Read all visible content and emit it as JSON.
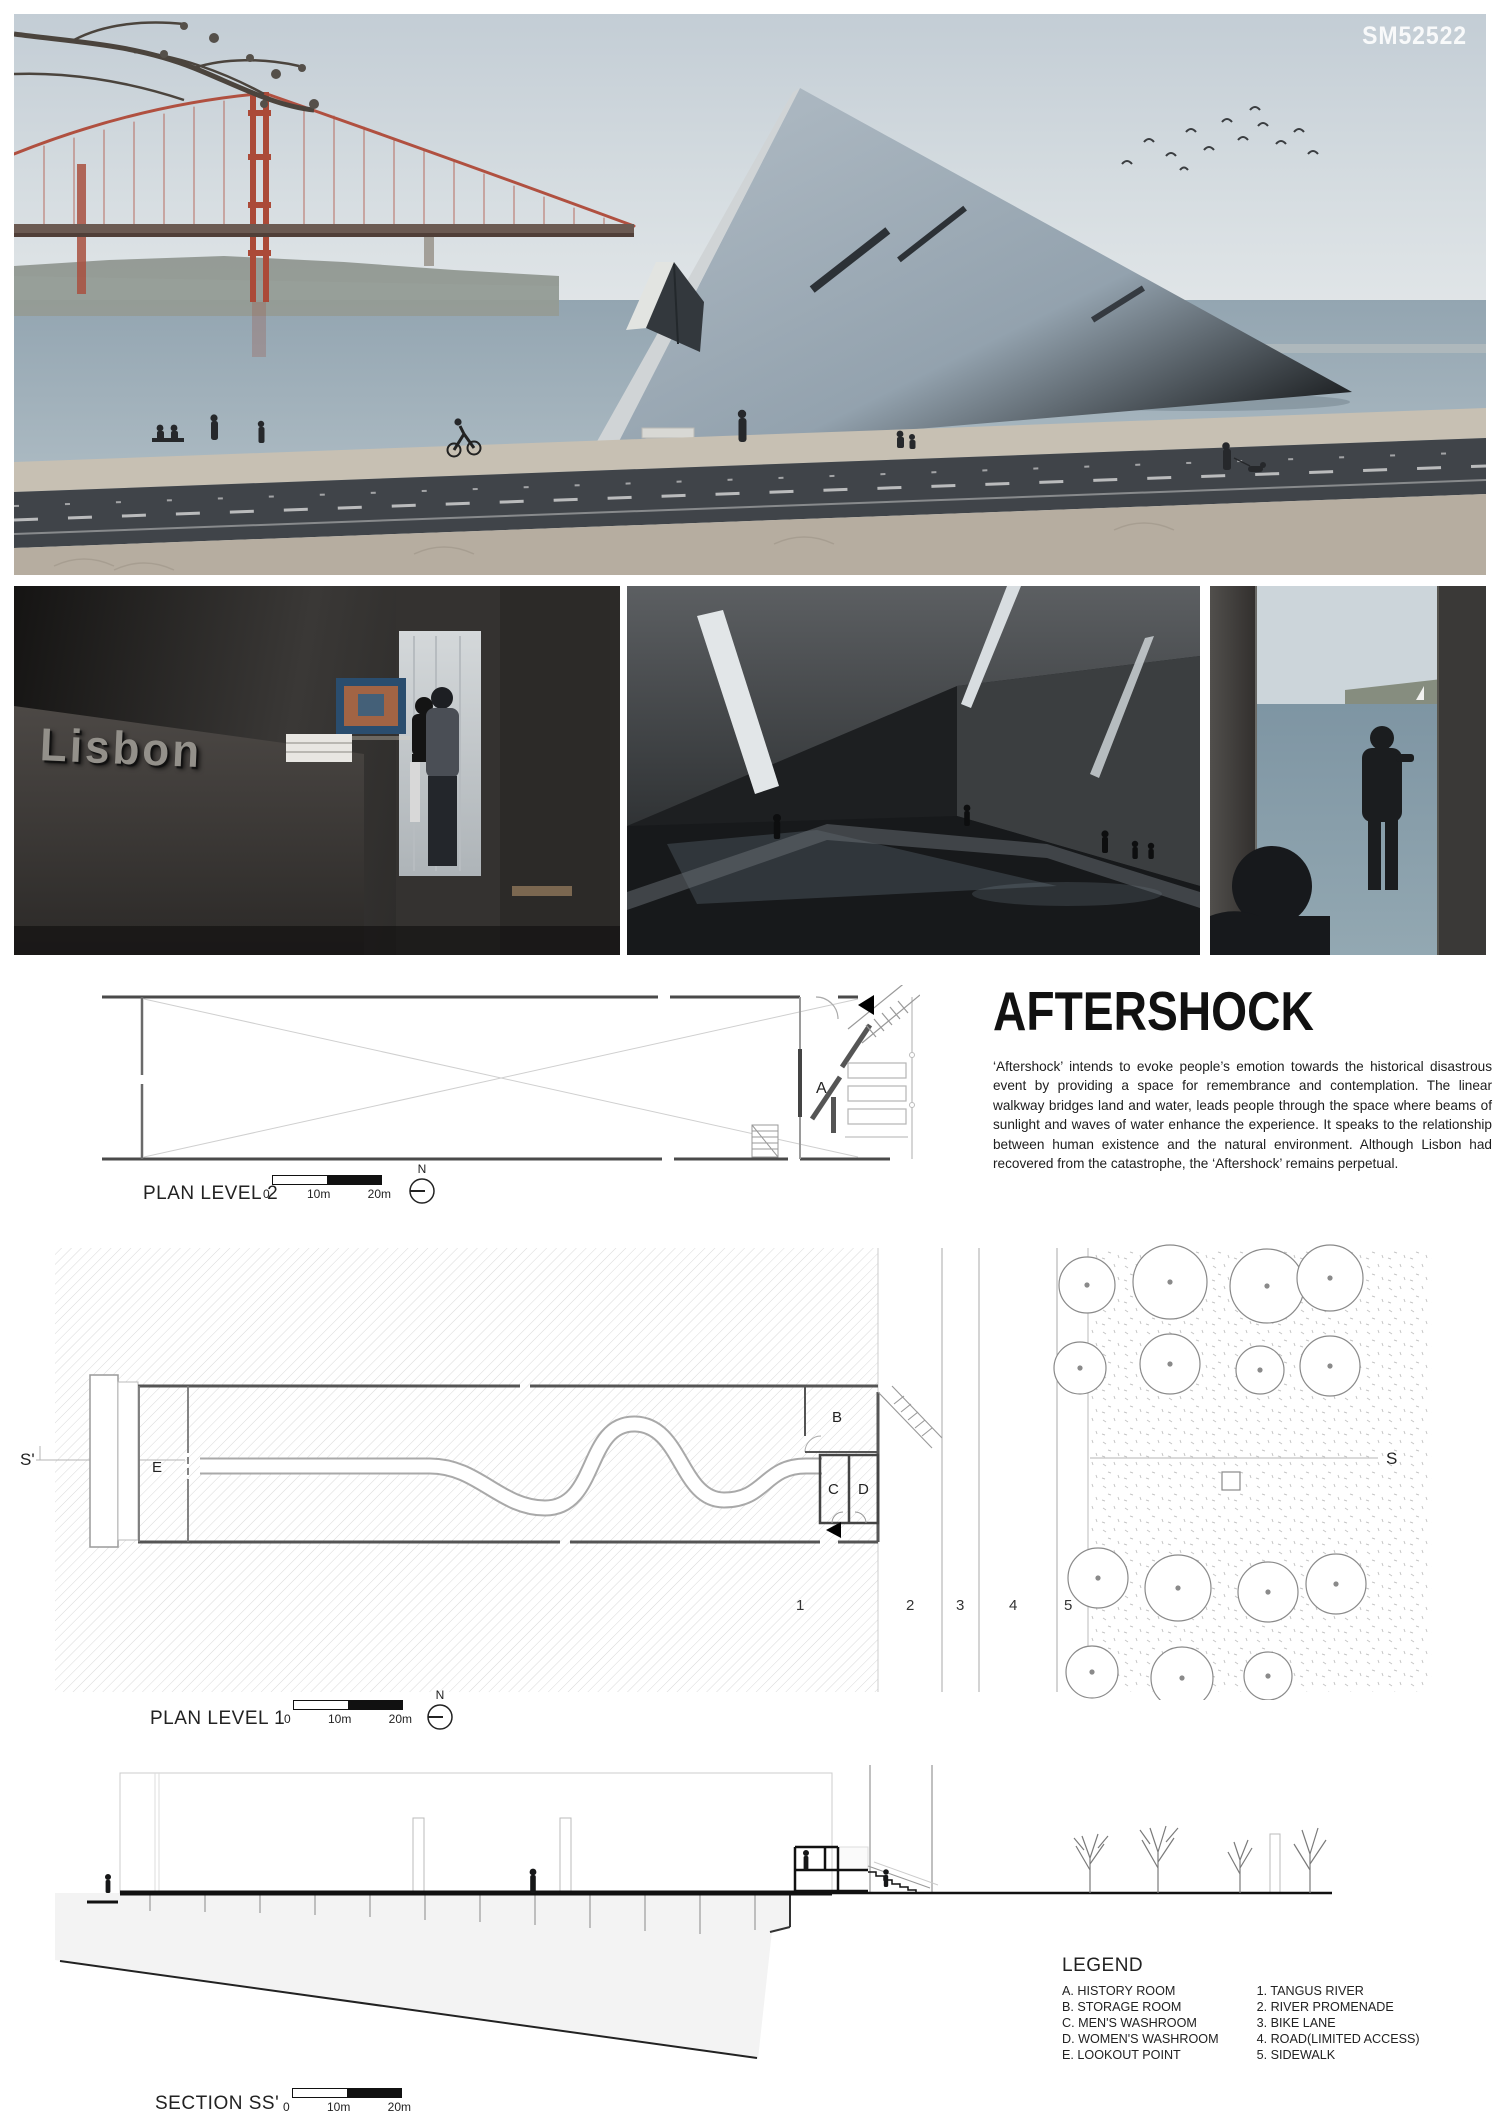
{
  "code": "SM52522",
  "title_block": {
    "title": "AFTERSHOCK",
    "paragraph": "‘Aftershock’ intends to evoke people’s emotion towards the historical disastrous event by providing a space for remembrance and contemplation. The linear walkway bridges land and water, leads people through the space where beams of sunlight and waves of water enhance the experience. It speaks to the relationship between human existence and the natural environment. Although Lisbon had recovered from the catastrophe, the ‘Aftershock’ remains perpetual."
  },
  "renders": {
    "lisbon_sign": "Lisbon"
  },
  "scalebar": {
    "zero": "0",
    "ten": "10m",
    "twenty": "20m"
  },
  "compass": {
    "label": "N"
  },
  "plan2": {
    "label": "PLAN LEVEL 2",
    "room_a": "A"
  },
  "plan1": {
    "label": "PLAN LEVEL 1",
    "room_b": "B",
    "room_c": "C",
    "room_d": "D",
    "room_e": "E",
    "zone_1": "1",
    "zone_2": "2",
    "zone_3": "3",
    "zone_4": "4",
    "zone_5": "5",
    "marker_s": "S",
    "marker_s_prime": "S'"
  },
  "section": {
    "label": "SECTION SS'"
  },
  "legend": {
    "heading": "LEGEND",
    "rooms": [
      "A. HISTORY ROOM",
      "B. STORAGE ROOM",
      "C. MEN'S WASHROOM",
      "D. WOMEN'S WASHROOM",
      "E. LOOKOUT POINT"
    ],
    "site": [
      "1. TANGUS RIVER",
      "2. RIVER PROMENADE",
      "3. BIKE LANE",
      "4. ROAD(LIMITED ACCESS)",
      "5. SIDEWALK"
    ]
  }
}
